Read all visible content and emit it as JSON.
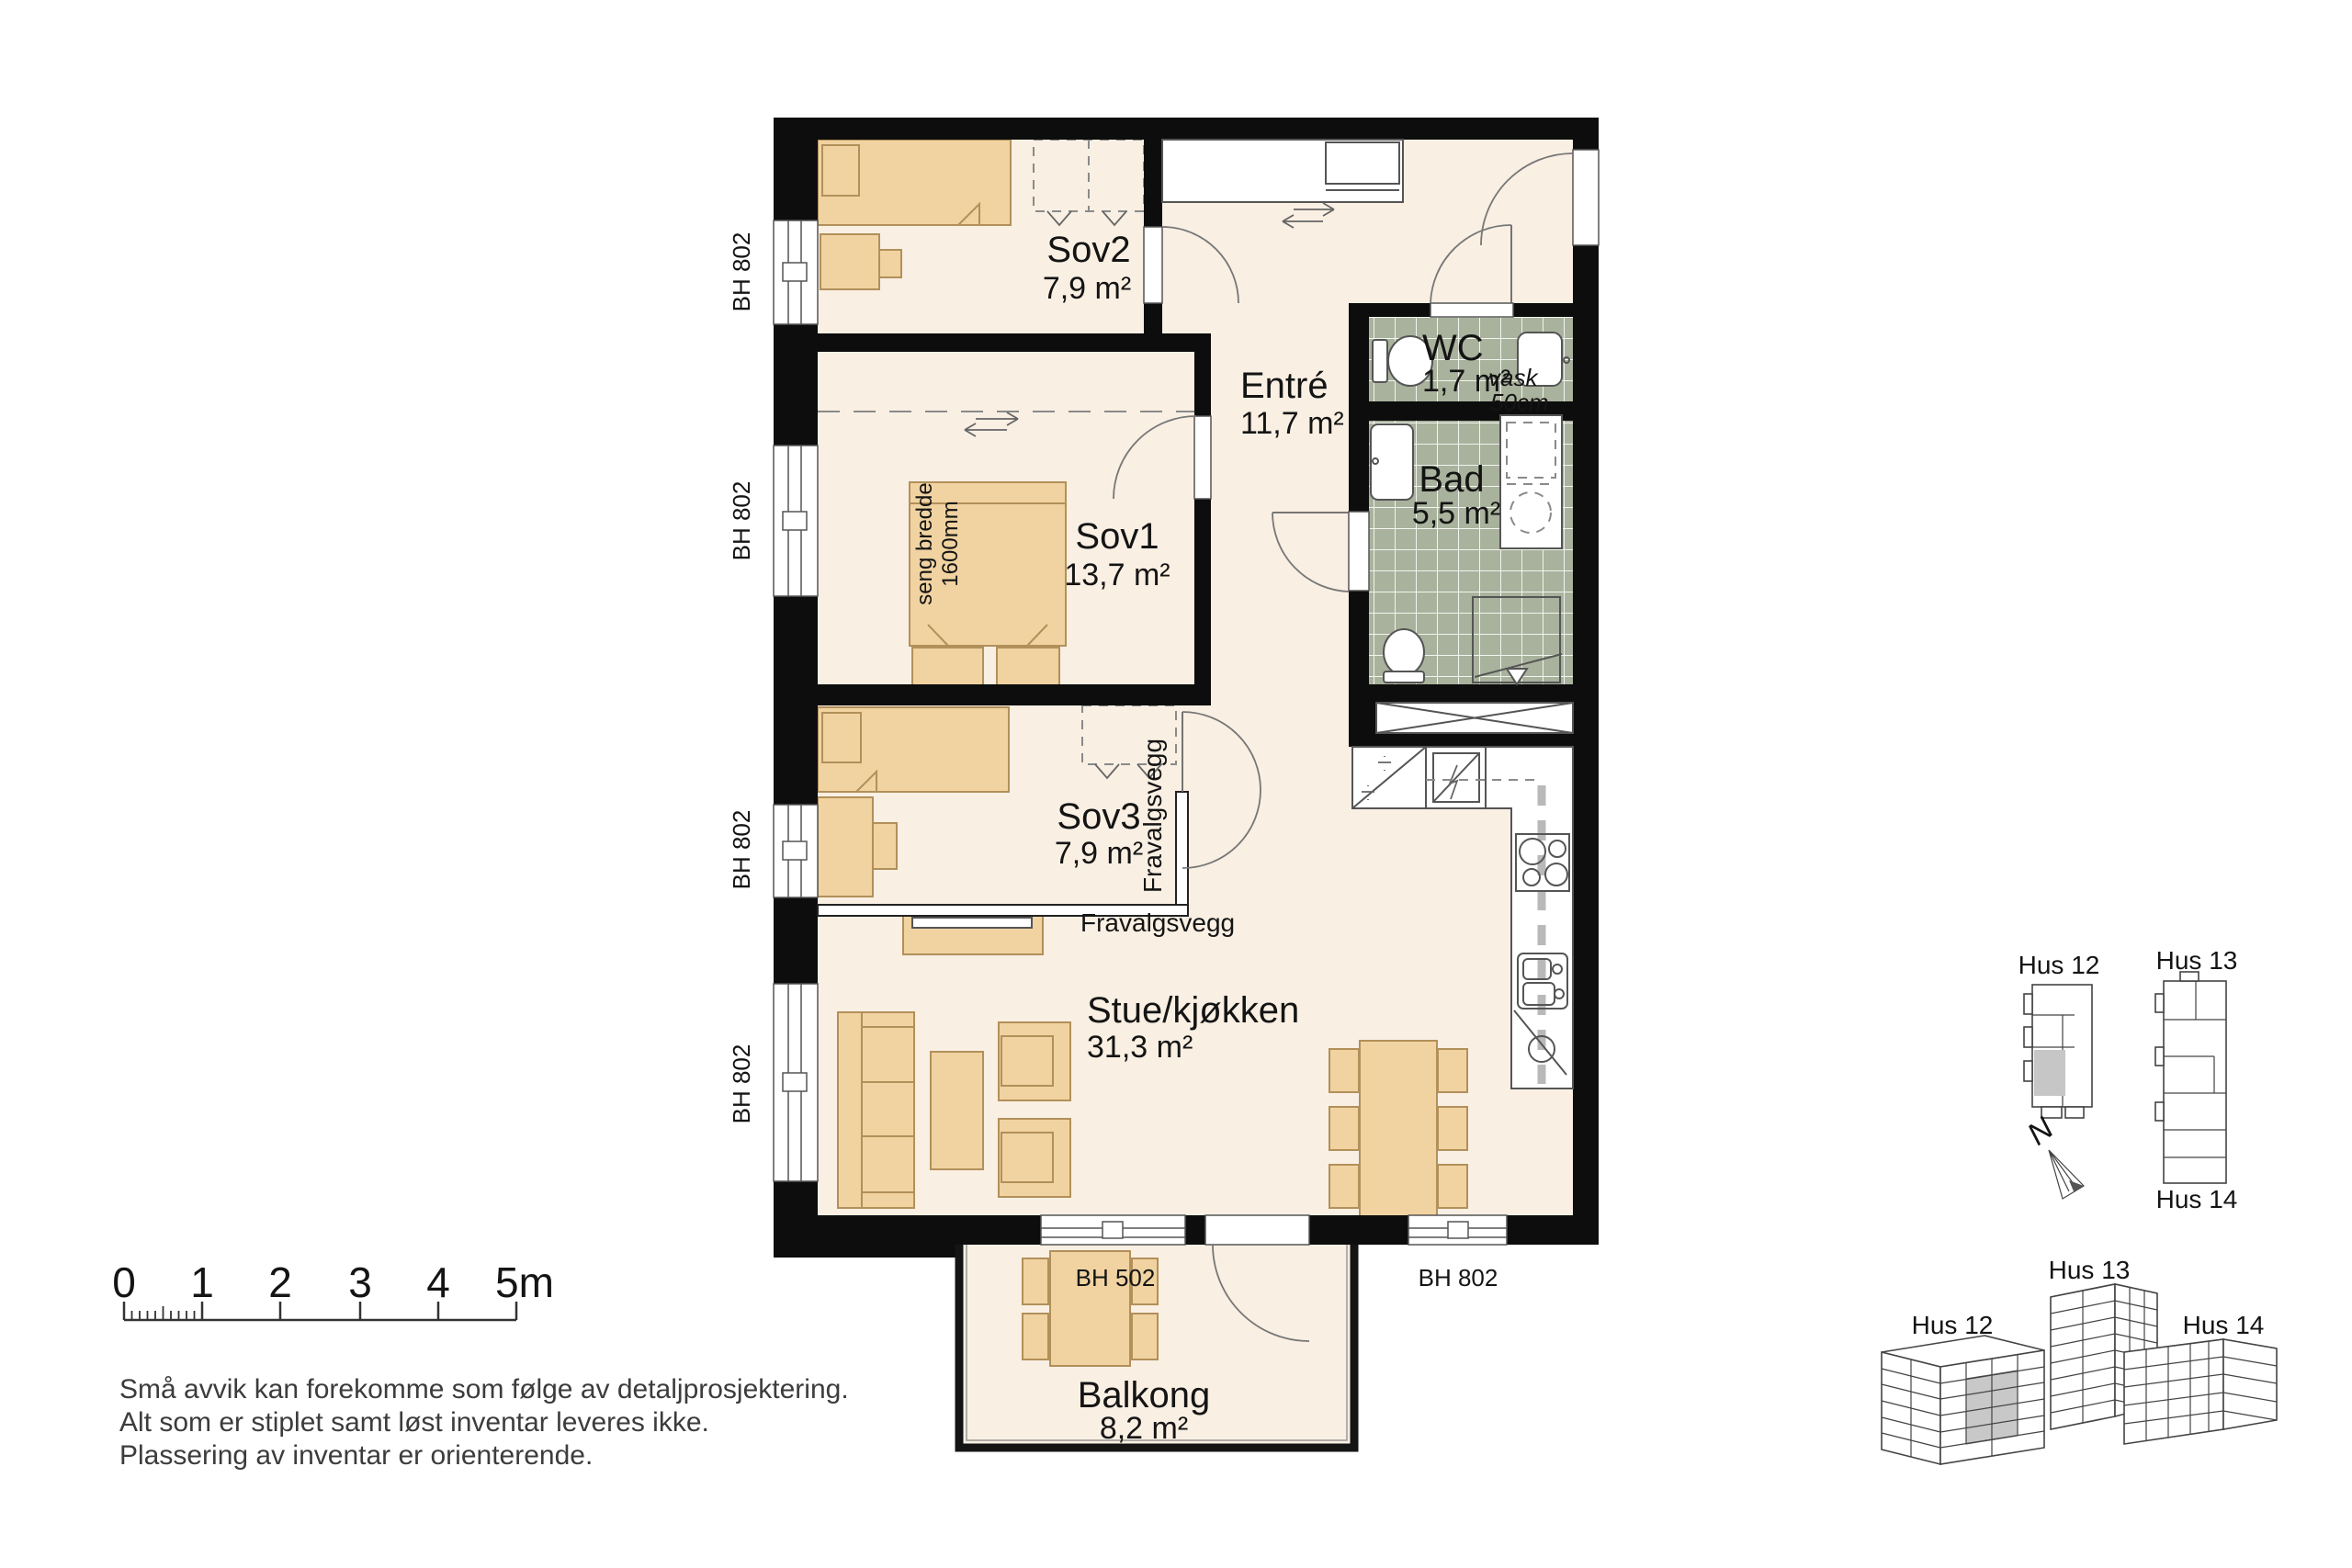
{
  "rooms": {
    "sov2": {
      "name": "Sov2",
      "area": "7,9 m²"
    },
    "sov1": {
      "name": "Sov1",
      "area": "13,7 m²"
    },
    "sov3": {
      "name": "Sov3",
      "area": "7,9 m²"
    },
    "entre": {
      "name": "Entré",
      "area": "11,7 m²"
    },
    "wc": {
      "name": "WC",
      "area": "1,7 m²"
    },
    "bad": {
      "name": "Bad",
      "area": "5,5 m²"
    },
    "stue": {
      "name": "Stue/kjøkken",
      "area": "31,3 m²"
    },
    "balkong": {
      "name": "Balkong",
      "area": "8,2 m²"
    }
  },
  "annotations": {
    "wc_sink_label": "vask",
    "wc_sink_size": "50cm",
    "bed_width_label": "seng bredde",
    "bed_width_value": "1600mm",
    "optional_wall_vertical": "Fravalgsvegg",
    "optional_wall_horizontal": "Fravalgsvegg",
    "north_label": "N"
  },
  "window_labels": {
    "left_1": "BH 802",
    "left_2": "BH 802",
    "left_3": "BH 802",
    "left_4": "BH 802",
    "balcony_door": "BH 502",
    "bottom_right": "BH 802"
  },
  "scale_bar": {
    "ticks": [
      "0",
      "1",
      "2",
      "3",
      "4",
      "5m"
    ]
  },
  "disclaimer": {
    "line1": "Små avvik kan forekomme som følge av detaljprosjektering.",
    "line2": "Alt som er stiplet samt løst inventar leveres ikke.",
    "line3": "Plassering av inventar er orienterende."
  },
  "site_plan": {
    "hus12": "Hus 12",
    "hus13": "Hus 13",
    "hus14": "Hus 14"
  },
  "iso_view": {
    "hus12": "Hus 12",
    "hus13": "Hus 13",
    "hus14": "Hus 14"
  },
  "colors": {
    "floor": "#f9efe3",
    "furniture": "#f0d3a1",
    "furniture_stroke": "#b2905a",
    "tile": "#a9b29c",
    "wall": "#0d0d0d",
    "unit_highlight": "#c6c6c6"
  }
}
